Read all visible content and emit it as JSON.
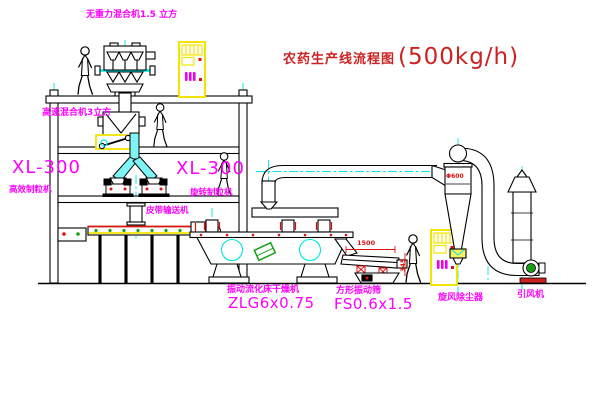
{
  "title": {
    "name": "农药生产线流程图",
    "capacity": "(500kg/h)"
  },
  "labels": {
    "gravity_mixer": "无重力混合机1.5 立方",
    "speed_mixer": "高速混合机3立方",
    "granulator_left_model": "XL-300",
    "granulator_left_name": "高效制粒机",
    "granulator_right_model": "XL-300",
    "granulator_right_name": "旋转制粒机",
    "belt_conveyor": "皮带输送机",
    "dryer_name": "振动流化床干燥机",
    "dryer_model": "ZLG6x0.75",
    "sieve_name": "方形振动筛",
    "sieve_model": "FS0.6x1.5",
    "cyclone_name": "旋风除尘器",
    "fan_name": "引风机"
  },
  "dimensions": {
    "sieve_length": "1500",
    "sieve_side": "345",
    "cyclone_diameter": "Φ600"
  },
  "colors": {
    "outline": "#000000",
    "centerline": "#00e5e5",
    "label_magenta": "#ff00ff",
    "title_red": "#cc2222",
    "dimension_red": "#dd1111",
    "cabinet_yellow": "#f2e400",
    "motor_green": "#18a018",
    "collector_yellow": "#f8f060",
    "chute_cyan": "#7ff4f4"
  }
}
